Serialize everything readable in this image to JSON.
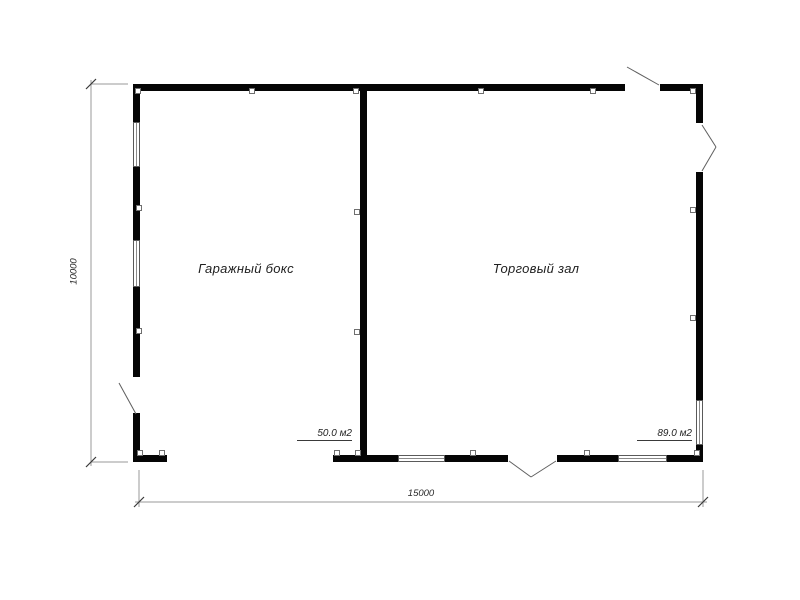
{
  "title": "Floor plan",
  "plan": {
    "rooms": [
      {
        "label": "Гаражный бокс",
        "area": "50.0 м2"
      },
      {
        "label": "Торговый зал",
        "area": "89.0 м2"
      }
    ],
    "dimensions": {
      "width": "15000",
      "height": "10000"
    }
  },
  "colors": {
    "wall": "#050505",
    "dimension_line": "#9a9a9a",
    "tick": "#3a3a3a",
    "door_leaf": "#5f5f5f",
    "text": "#1f1f1f"
  }
}
